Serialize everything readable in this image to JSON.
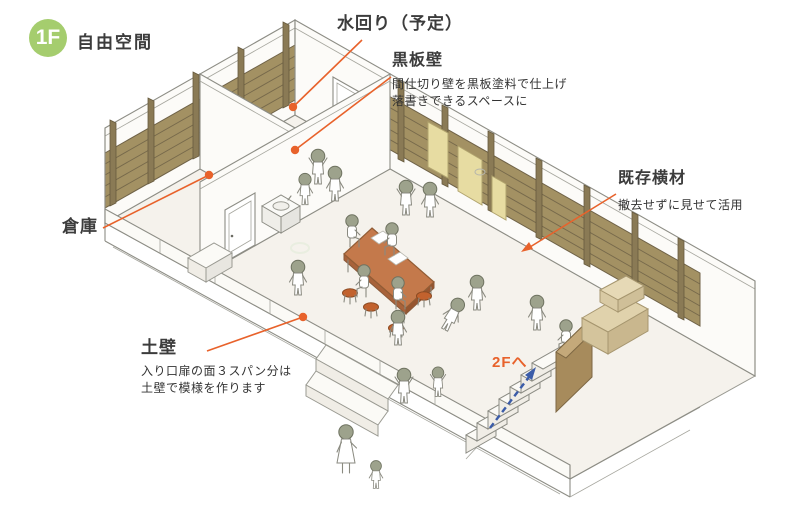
{
  "badge": {
    "floor": "1F",
    "title": "自由空間"
  },
  "annotations": {
    "water_area": {
      "title": "水回り（予定）"
    },
    "blackboard_wall": {
      "title": "黒板壁",
      "desc_line1": "間仕切り壁を黒板塗料で仕上げ",
      "desc_line2": "落書きできるスペースに"
    },
    "existing_timber": {
      "title": "既存横材",
      "desc_line1": "撤去せずに見せて活用"
    },
    "storage": {
      "title": "倉庫"
    },
    "earthen_wall": {
      "title": "土壁",
      "desc_line1": "入り口扉の面３スパン分は",
      "desc_line2": "土壁で模様を作ります"
    },
    "stairs_up": {
      "title": "2Fへ"
    }
  },
  "colors": {
    "badge_green": "#A5CD6E",
    "leader_orange": "#E8622B",
    "arrow_blue": "#3B5CA8",
    "wood_slat": "#A39163",
    "table_top": "#C4794B",
    "board_yellow": "#E7DCA2",
    "label_text": "#3C3C3C"
  },
  "icons": {
    "floor_badge": "green-circle-1f",
    "leader_dot": "orange-dot",
    "timber_pointer": "orange-arrowhead",
    "stairs_direction": "blue-dashed-arrow-up"
  }
}
